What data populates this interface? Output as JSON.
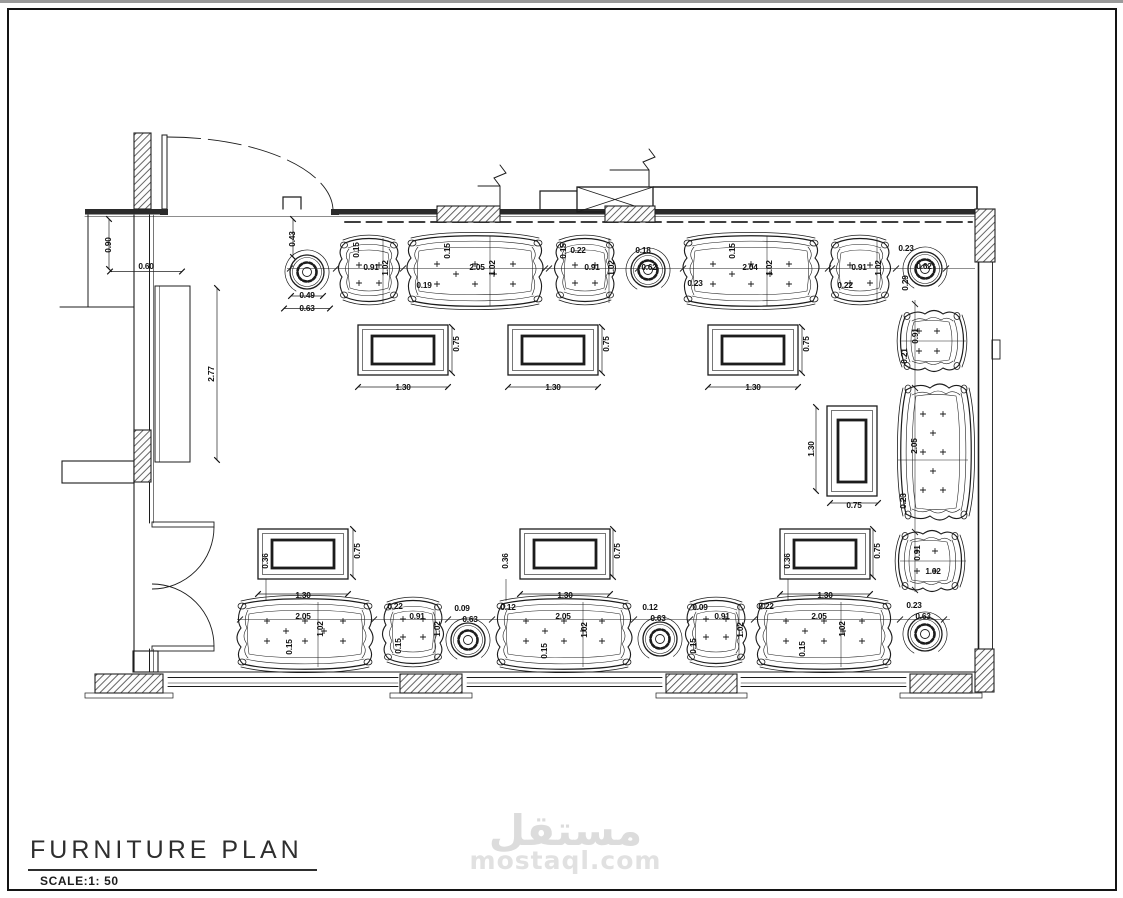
{
  "title": {
    "text": "FURNITURE PLAN",
    "scale_label": "SCALE:1: 50"
  },
  "watermark": {
    "arabic": "مستقل",
    "latin": "mostaql.com"
  },
  "colors": {
    "line": "#1c1c1c",
    "wall": "#2b2b2b",
    "watermark": "#dcdcdc"
  },
  "drawing": {
    "annotations": [
      {
        "t": "0.90",
        "x": 109,
        "y": 245,
        "r": -90
      },
      {
        "t": "0.60",
        "x": 146,
        "y": 267,
        "r": 0
      },
      {
        "t": "2.77",
        "x": 212,
        "y": 374,
        "r": -90
      },
      {
        "t": "0.43",
        "x": 293,
        "y": 239,
        "r": -90
      },
      {
        "t": "0.49",
        "x": 307,
        "y": 296,
        "r": 0
      },
      {
        "t": "0.63",
        "x": 307,
        "y": 309,
        "r": 0
      },
      {
        "t": "0.15",
        "x": 357,
        "y": 250,
        "r": -90
      },
      {
        "t": "0.91",
        "x": 371,
        "y": 268,
        "r": 0
      },
      {
        "t": "1.02",
        "x": 386,
        "y": 268,
        "r": -90
      },
      {
        "t": "0.19",
        "x": 424,
        "y": 286,
        "r": 0
      },
      {
        "t": "0.15",
        "x": 448,
        "y": 251,
        "r": -90
      },
      {
        "t": "2.05",
        "x": 477,
        "y": 268,
        "r": 0
      },
      {
        "t": "1.02",
        "x": 493,
        "y": 268,
        "r": -90
      },
      {
        "t": "0.15",
        "x": 564,
        "y": 251,
        "r": -90
      },
      {
        "t": "0.22",
        "x": 578,
        "y": 251,
        "r": 0
      },
      {
        "t": "0.91",
        "x": 592,
        "y": 268,
        "r": 0
      },
      {
        "t": "1.02",
        "x": 612,
        "y": 268,
        "r": -90
      },
      {
        "t": "0.18",
        "x": 643,
        "y": 251,
        "r": 0
      },
      {
        "t": "0.62",
        "x": 649,
        "y": 268,
        "r": 0
      },
      {
        "t": "0.23",
        "x": 695,
        "y": 284,
        "r": 0
      },
      {
        "t": "0.15",
        "x": 733,
        "y": 251,
        "r": -90
      },
      {
        "t": "2.04",
        "x": 750,
        "y": 268,
        "r": 0
      },
      {
        "t": "1.02",
        "x": 770,
        "y": 268,
        "r": -90
      },
      {
        "t": "0.22",
        "x": 845,
        "y": 286,
        "r": 0
      },
      {
        "t": "0.91",
        "x": 859,
        "y": 268,
        "r": 0
      },
      {
        "t": "1.02",
        "x": 879,
        "y": 268,
        "r": -90
      },
      {
        "t": "0.23",
        "x": 906,
        "y": 249,
        "r": 0
      },
      {
        "t": "0.62",
        "x": 924,
        "y": 267,
        "r": 0
      },
      {
        "t": "0.29",
        "x": 906,
        "y": 283,
        "r": -90
      },
      {
        "t": "1.30",
        "x": 403,
        "y": 388,
        "r": 0
      },
      {
        "t": "0.75",
        "x": 457,
        "y": 344,
        "r": -90
      },
      {
        "t": "1.30",
        "x": 553,
        "y": 388,
        "r": 0
      },
      {
        "t": "0.75",
        "x": 607,
        "y": 344,
        "r": -90
      },
      {
        "t": "1.30",
        "x": 753,
        "y": 388,
        "r": 0
      },
      {
        "t": "0.75",
        "x": 807,
        "y": 344,
        "r": -90
      },
      {
        "t": "0.91",
        "x": 916,
        "y": 336,
        "r": -90
      },
      {
        "t": "0.21",
        "x": 905,
        "y": 356,
        "r": -90
      },
      {
        "t": "2.05",
        "x": 915,
        "y": 446,
        "r": -90
      },
      {
        "t": "0.23",
        "x": 904,
        "y": 501,
        "r": -90
      },
      {
        "t": "1.30",
        "x": 812,
        "y": 449,
        "r": -90
      },
      {
        "t": "0.75",
        "x": 854,
        "y": 506,
        "r": 0
      },
      {
        "t": "0.91",
        "x": 918,
        "y": 553,
        "r": -90
      },
      {
        "t": "1.02",
        "x": 933,
        "y": 572,
        "r": 0
      },
      {
        "t": "0.36",
        "x": 266,
        "y": 561,
        "r": -90
      },
      {
        "t": "1.30",
        "x": 303,
        "y": 596,
        "r": 0
      },
      {
        "t": "0.75",
        "x": 358,
        "y": 551,
        "r": -90
      },
      {
        "t": "0.36",
        "x": 506,
        "y": 561,
        "r": -90
      },
      {
        "t": "1.30",
        "x": 565,
        "y": 596,
        "r": 0
      },
      {
        "t": "0.75",
        "x": 618,
        "y": 551,
        "r": -90
      },
      {
        "t": "0.36",
        "x": 788,
        "y": 561,
        "r": -90
      },
      {
        "t": "1.30",
        "x": 825,
        "y": 596,
        "r": 0
      },
      {
        "t": "0.75",
        "x": 878,
        "y": 551,
        "r": -90
      },
      {
        "t": "2.05",
        "x": 303,
        "y": 617,
        "r": 0
      },
      {
        "t": "1.02",
        "x": 321,
        "y": 629,
        "r": -90
      },
      {
        "t": "0.15",
        "x": 290,
        "y": 647,
        "r": -90
      },
      {
        "t": "0.22",
        "x": 395,
        "y": 607,
        "r": 0
      },
      {
        "t": "0.91",
        "x": 417,
        "y": 617,
        "r": 0
      },
      {
        "t": "1.02",
        "x": 438,
        "y": 629,
        "r": -90
      },
      {
        "t": "0.15",
        "x": 399,
        "y": 646,
        "r": -90
      },
      {
        "t": "0.09",
        "x": 462,
        "y": 609,
        "r": 0
      },
      {
        "t": "0.63",
        "x": 470,
        "y": 620,
        "r": 0
      },
      {
        "t": "0.12",
        "x": 508,
        "y": 608,
        "r": 0
      },
      {
        "t": "2.05",
        "x": 563,
        "y": 617,
        "r": 0
      },
      {
        "t": "1.02",
        "x": 585,
        "y": 630,
        "r": -90
      },
      {
        "t": "0.15",
        "x": 545,
        "y": 651,
        "r": -90
      },
      {
        "t": "0.12",
        "x": 650,
        "y": 608,
        "r": 0
      },
      {
        "t": "0.63",
        "x": 658,
        "y": 619,
        "r": 0
      },
      {
        "t": "0.09",
        "x": 700,
        "y": 608,
        "r": 0
      },
      {
        "t": "0.91",
        "x": 722,
        "y": 617,
        "r": 0
      },
      {
        "t": "1.02",
        "x": 741,
        "y": 630,
        "r": -90
      },
      {
        "t": "0.15",
        "x": 694,
        "y": 646,
        "r": -90
      },
      {
        "t": "0.22",
        "x": 766,
        "y": 607,
        "r": 0
      },
      {
        "t": "2.05",
        "x": 819,
        "y": 617,
        "r": 0
      },
      {
        "t": "1.02",
        "x": 843,
        "y": 629,
        "r": -90
      },
      {
        "t": "0.15",
        "x": 803,
        "y": 649,
        "r": -90
      },
      {
        "t": "0.23",
        "x": 914,
        "y": 606,
        "r": 0
      },
      {
        "t": "0.63",
        "x": 923,
        "y": 617,
        "r": 0
      }
    ]
  }
}
